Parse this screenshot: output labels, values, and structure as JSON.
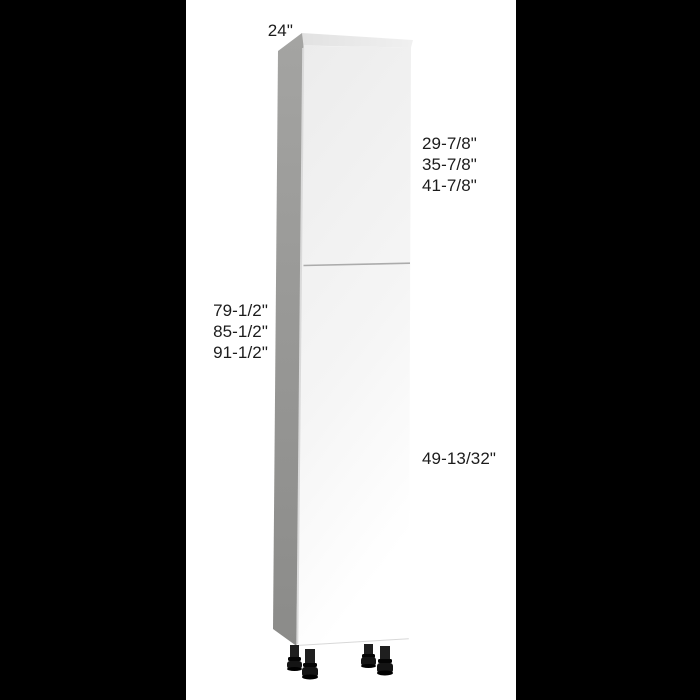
{
  "scene": {
    "letterbox_color": "#000000",
    "panel_background": "#ffffff"
  },
  "cabinet": {
    "kind": "tall-pantry-cabinet-two-doors-adjustable-legs",
    "colors": {
      "side_panel_top": "#a4a4a2",
      "side_panel_bottom": "#8b8b89",
      "top_panel": "#e7e7e7",
      "front_panel_top": "#ececec",
      "front_panel_bottom": "#ffffff",
      "door_seam": "#ababab",
      "edge_highlight": "#dadada",
      "bottom_edge": "#d8d8d8",
      "leg": "#1f1f1f"
    }
  },
  "dimensions": {
    "text_color": "#1c1c1c",
    "top_width": "24\"",
    "upper_door_height_options": [
      "29-7/8\"",
      "35-7/8\"",
      "41-7/8\""
    ],
    "total_height_options": [
      "79-1/2\"",
      "85-1/2\"",
      "91-1/2\""
    ],
    "lower_door_height": "49-13/32\""
  }
}
